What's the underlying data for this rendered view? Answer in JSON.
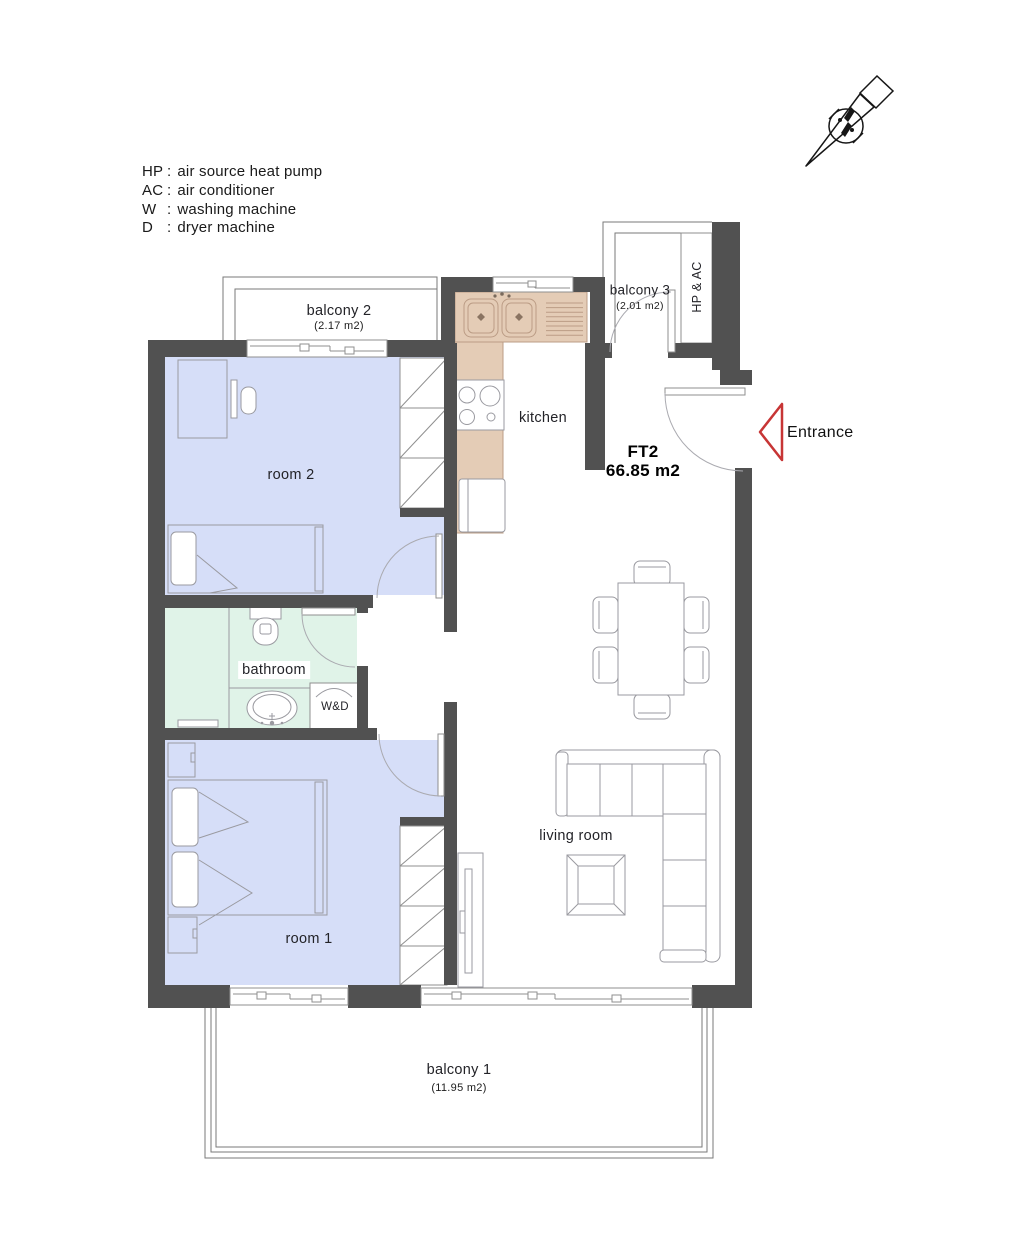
{
  "legend": {
    "items": [
      {
        "abbr": "HP",
        "desc": "air source heat pump"
      },
      {
        "abbr": "AC",
        "desc": "air conditioner"
      },
      {
        "abbr": "W",
        "desc": "washing machine"
      },
      {
        "abbr": "D",
        "desc": "dryer machine"
      }
    ]
  },
  "unit": {
    "code": "FT2",
    "area": "66.85 m2"
  },
  "entrance": {
    "label": "Entrance"
  },
  "rooms": {
    "room2": {
      "label": "room 2"
    },
    "room1": {
      "label": "room 1"
    },
    "kitchen": {
      "label": "kitchen"
    },
    "bathroom": {
      "label": "bathroom"
    },
    "living_room": {
      "label": "living room"
    },
    "wd": {
      "label": "W&D"
    },
    "hp_ac": {
      "label": "HP & AC"
    },
    "balcony1": {
      "label": "balcony 1",
      "area": "(11.95 m2)"
    },
    "balcony2": {
      "label": "balcony 2",
      "area": "(2.17 m2)"
    },
    "balcony3": {
      "label": "balcony 3",
      "area": "(2.01 m2)"
    }
  },
  "colors": {
    "wall": "#515151",
    "room_fill": "#d6def8",
    "bathroom_fill": "#e0f3e8",
    "counter_fill": "#e4ccb6",
    "entrance_accent": "#c73535"
  }
}
